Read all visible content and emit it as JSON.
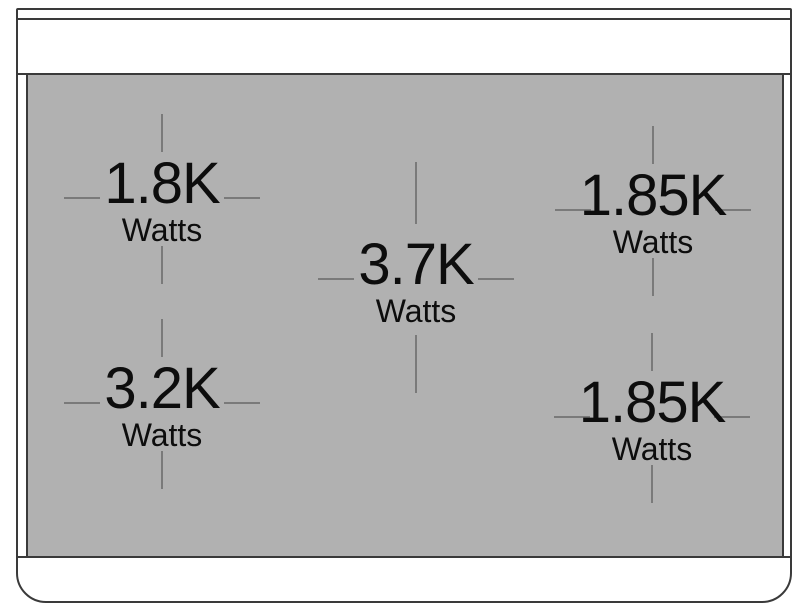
{
  "colors": {
    "surface": "#b1b1b1",
    "tick": "#7a7a7a",
    "line": "#3a3a3a",
    "text": "#0d0d0d",
    "panel": "#ffffff"
  },
  "burners": [
    {
      "position": "top-left",
      "power": "1.8K",
      "unit": "Watts"
    },
    {
      "position": "top-right",
      "power": "1.85K",
      "unit": "Watts"
    },
    {
      "position": "center",
      "power": "3.7K",
      "unit": "Watts"
    },
    {
      "position": "bottom-left",
      "power": "3.2K",
      "unit": "Watts"
    },
    {
      "position": "bottom-right",
      "power": "1.85K",
      "unit": "Watts"
    }
  ]
}
